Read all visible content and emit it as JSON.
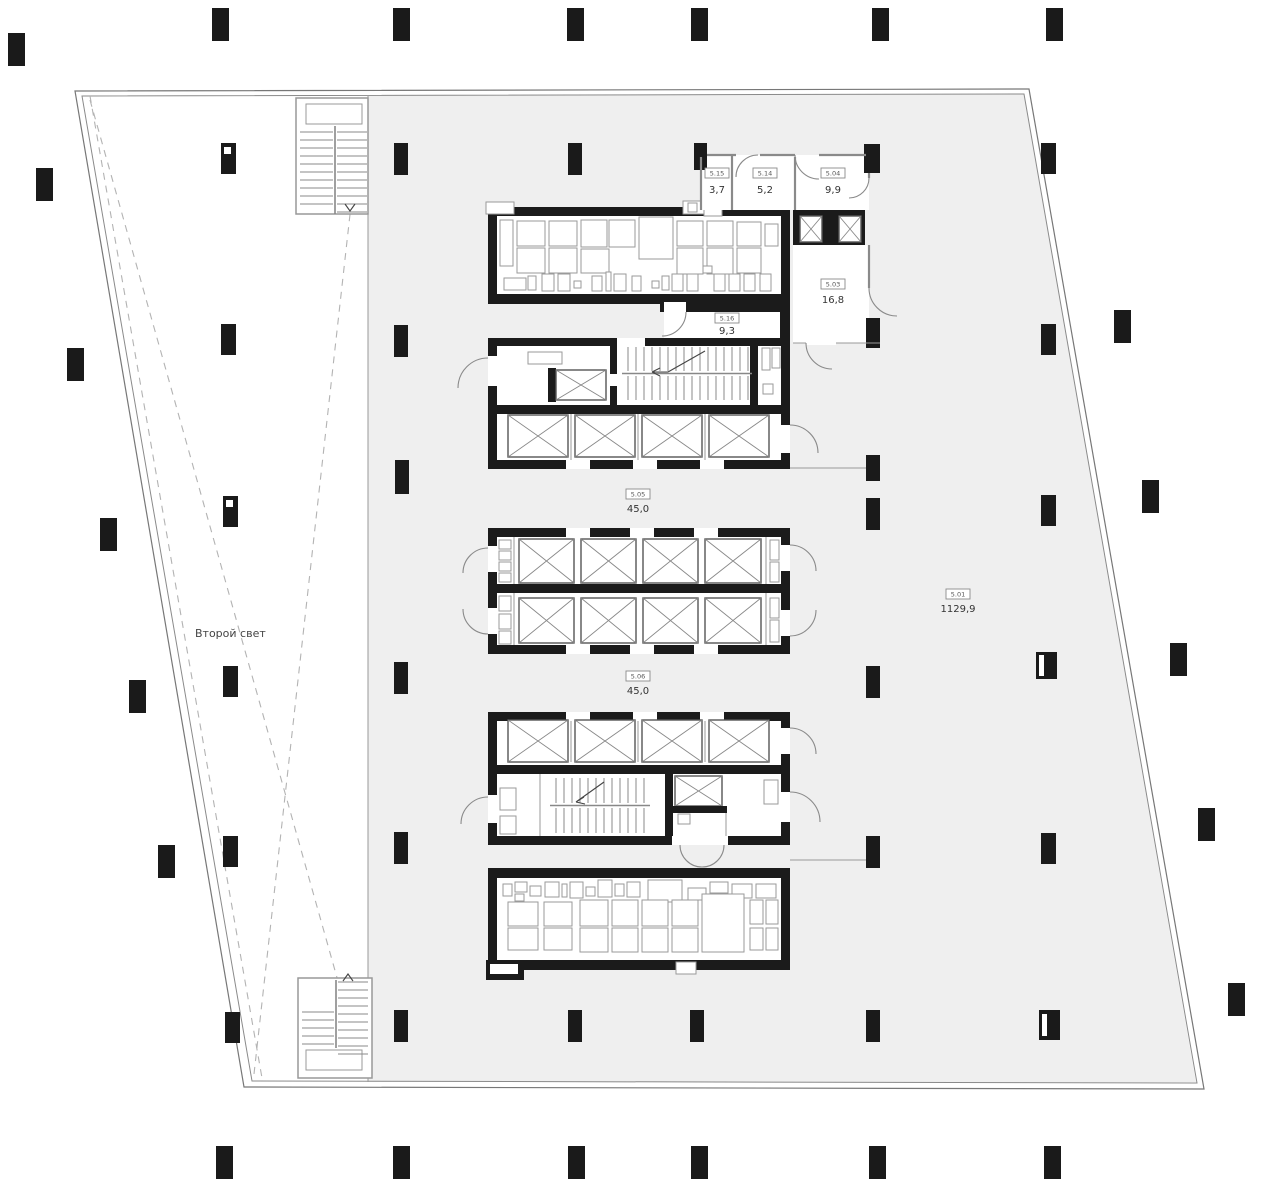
{
  "document": {
    "type": "architectural-floor-plan",
    "language": "ru"
  },
  "colors": {
    "background": "#ffffff",
    "floor_fill": "#efefef",
    "wall": "#1b1b1b",
    "thin_line": "#8a8a8a",
    "dashed_line": "#b3b3b3"
  },
  "void_area": {
    "label": "Второй свет"
  },
  "rooms": [
    {
      "id": "5.15",
      "area": "3,7"
    },
    {
      "id": "5.14",
      "area": "5,2"
    },
    {
      "id": "5.04",
      "area": "9,9"
    },
    {
      "id": "5.03",
      "area": "16,8"
    },
    {
      "id": "5.16",
      "area": "9,3"
    },
    {
      "id": "5.05",
      "area": "45,0"
    },
    {
      "id": "5.06",
      "area": "45,0"
    },
    {
      "id": "5.01",
      "area": "1129,9"
    }
  ]
}
